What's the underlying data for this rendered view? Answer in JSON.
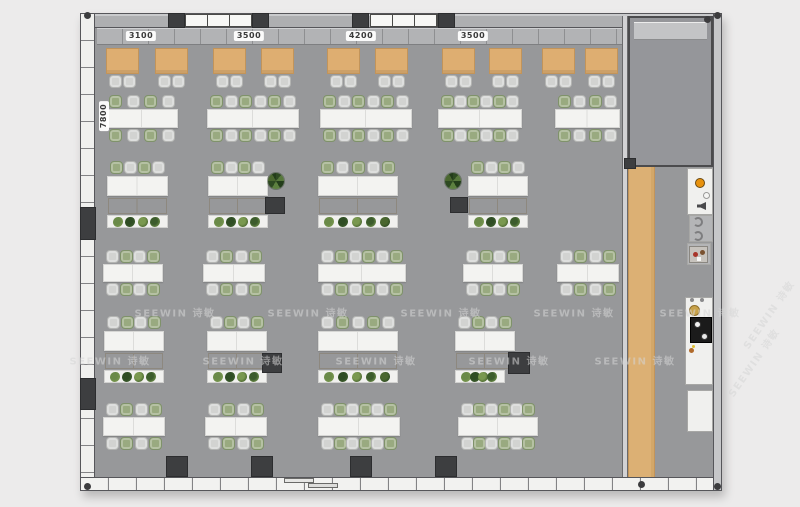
{
  "title": "Office floor plan",
  "dimension_labels": {
    "top_y": 36,
    "top": [
      {
        "text": "3100",
        "cx": 141
      },
      {
        "text": "3500",
        "cx": 249
      },
      {
        "text": "4200",
        "cx": 361
      },
      {
        "text": "3500",
        "cx": 473
      }
    ],
    "left": {
      "text": "7800",
      "cx": 104,
      "cy": 116
    }
  },
  "watermark": {
    "text": "SEEWIN 诗敏",
    "color": "#d6d6d6",
    "flat": [
      {
        "x": 175,
        "y": 312
      },
      {
        "x": 308,
        "y": 312
      },
      {
        "x": 441,
        "y": 312
      },
      {
        "x": 574,
        "y": 312
      },
      {
        "x": 700,
        "y": 312
      },
      {
        "x": 110,
        "y": 360
      },
      {
        "x": 243,
        "y": 360
      },
      {
        "x": 376,
        "y": 360
      },
      {
        "x": 509,
        "y": 360
      },
      {
        "x": 635,
        "y": 360
      }
    ],
    "rotated": [
      {
        "x": 768,
        "y": 314,
        "rot": -55
      },
      {
        "x": 753,
        "y": 362,
        "rot": -55
      }
    ]
  },
  "palette": {
    "floor": "#97989a",
    "wood_table": "#deae71",
    "wood_border": "#c2945a",
    "chair_gray": "#d2d3d1",
    "chair_gray_border": "#b3b4b2",
    "chair_green": "#99aa80",
    "chair_green_border": "#7f926a",
    "table_white": "#f3f3f1",
    "table_border": "#d6d6d4",
    "cabinet": "#aaa49c",
    "pillar": "#3d3e40",
    "walkway_wood": "#dcb074",
    "plant_greens": [
      "#4a672f",
      "#6a8a48",
      "#2f4d24",
      "#79984f",
      "#3c5c2c"
    ]
  },
  "furniture": {
    "booth_tables": {
      "y": 48,
      "w": 33,
      "h": 26,
      "chair_y": 75,
      "xs": [
        106,
        155,
        213,
        261,
        327,
        375,
        442,
        489,
        542,
        585
      ]
    },
    "meeting_rows": [
      {
        "name": "row-b",
        "table_y": 109,
        "table_h": 19,
        "phase": 0,
        "clusters": [
          {
            "x": 106,
            "w": 72,
            "seats": 4
          },
          {
            "x": 207,
            "w": 92,
            "seats": 6
          },
          {
            "x": 320,
            "w": 92,
            "seats": 6
          },
          {
            "x": 438,
            "w": 84,
            "seats": 6
          },
          {
            "x": 555,
            "w": 65,
            "seats": 4
          }
        ]
      },
      {
        "name": "row-d",
        "table_y": 264,
        "table_h": 18,
        "phase": 1,
        "clusters": [
          {
            "x": 103,
            "w": 60,
            "seats": 4
          },
          {
            "x": 203,
            "w": 62,
            "seats": 4
          },
          {
            "x": 318,
            "w": 88,
            "seats": 6
          },
          {
            "x": 463,
            "w": 60,
            "seats": 4
          },
          {
            "x": 557,
            "w": 62,
            "seats": 4
          }
        ]
      },
      {
        "name": "row-f",
        "table_y": 417,
        "table_h": 19,
        "phase": 1,
        "clusters": [
          {
            "x": 103,
            "w": 62,
            "seats": 4
          },
          {
            "x": 205,
            "w": 62,
            "seats": 4
          },
          {
            "x": 318,
            "w": 82,
            "seats": 6
          },
          {
            "x": 458,
            "w": 80,
            "seats": 6
          }
        ]
      }
    ],
    "workstation_rows": [
      {
        "name": "row-c",
        "desk_y": 176,
        "phase": 0,
        "clusters": [
          {
            "x": 107,
            "w": 61,
            "seats": 4,
            "plants": 4
          },
          {
            "x": 208,
            "w": 60,
            "seats": 4,
            "plants": 4
          },
          {
            "x": 318,
            "w": 80,
            "seats": 5,
            "plants": 5
          },
          {
            "x": 468,
            "w": 60,
            "seats": 4,
            "plants": 4
          }
        ]
      },
      {
        "name": "row-e",
        "desk_y": 331,
        "phase": 1,
        "clusters": [
          {
            "x": 104,
            "w": 60,
            "seats": 4,
            "plants": 4
          },
          {
            "x": 207,
            "w": 60,
            "seats": 4,
            "plants": 4
          },
          {
            "x": 318,
            "w": 80,
            "seats": 5,
            "plants": 5
          },
          {
            "x": 455,
            "w": 60,
            "seats": 4,
            "plants": 4,
            "planter_w": 50
          }
        ]
      }
    ],
    "pillars": {
      "top_wall": [
        {
          "x": 168
        },
        {
          "x": 252
        },
        {
          "x": 352
        },
        {
          "x": 438
        }
      ],
      "top_wall_y": 13,
      "top_wall_w": 17,
      "top_wall_h": 15,
      "bottom_wall": [
        {
          "x": 166
        },
        {
          "x": 251
        },
        {
          "x": 350
        },
        {
          "x": 435
        }
      ],
      "bottom_wall_y": 456,
      "bottom_wall_w": 22,
      "bottom_wall_h": 21,
      "interior": [
        {
          "x": 265,
          "y": 197,
          "w": 20,
          "h": 17
        },
        {
          "x": 450,
          "y": 197,
          "w": 18,
          "h": 16
        },
        {
          "x": 262,
          "y": 353,
          "w": 20,
          "h": 20
        },
        {
          "x": 508,
          "y": 352,
          "w": 22,
          "h": 22
        },
        {
          "x": 624,
          "y": 158,
          "w": 12,
          "h": 11
        }
      ],
      "left_wall": [
        {
          "y": 207,
          "h": 33
        },
        {
          "y": 378,
          "h": 32
        }
      ]
    },
    "potted_plants": [
      {
        "x": 276,
        "y": 181
      },
      {
        "x": 453,
        "y": 181
      }
    ]
  },
  "kitchen": {
    "counters": [
      {
        "x": 687,
        "y": 168,
        "w": 26,
        "h": 47
      },
      {
        "x": 689,
        "y": 215,
        "w": 24,
        "h": 27,
        "shade": true
      },
      {
        "x": 687,
        "y": 243,
        "w": 24,
        "h": 22,
        "shade": true
      },
      {
        "x": 685,
        "y": 297,
        "w": 28,
        "h": 88
      },
      {
        "x": 687,
        "y": 390,
        "w": 26,
        "h": 42
      }
    ],
    "items": [
      {
        "type": "circle",
        "x": 700,
        "y": 183,
        "r": 5,
        "color": "#e8920e",
        "ring": "#6b4a12"
      },
      {
        "type": "circle",
        "x": 706,
        "y": 195,
        "r": 3.5,
        "color": "#f5f5f3",
        "ring": "#9a9a98"
      },
      {
        "type": "speaker",
        "x": 697,
        "y": 202,
        "w": 9,
        "h": 8
      },
      {
        "type": "arc",
        "x": 698,
        "y": 222,
        "r": 5
      },
      {
        "type": "arc",
        "x": 698,
        "y": 236,
        "r": 5
      },
      {
        "type": "machine",
        "x": 689,
        "y": 246,
        "w": 19,
        "h": 17
      },
      {
        "type": "circle",
        "x": 694,
        "y": 310,
        "r": 5.5,
        "color": "#c8a24a",
        "ring": "#8f6f2b"
      },
      {
        "type": "dot",
        "x": 692,
        "y": 300,
        "r": 2,
        "color": "#8a8a8c"
      },
      {
        "type": "dot",
        "x": 702,
        "y": 300,
        "r": 2,
        "color": "#8a8a8c"
      },
      {
        "type": "rect",
        "x": 690,
        "y": 317,
        "w": 22,
        "h": 26,
        "color": "#1b1b1b",
        "border": "#000000"
      },
      {
        "type": "circle",
        "x": 697,
        "y": 324,
        "r": 3.5,
        "color": "#f2f2f2",
        "ring": "#3a3a3a"
      },
      {
        "type": "circle",
        "x": 704,
        "y": 336,
        "r": 3.5,
        "color": "#e8e8e8",
        "ring": "#3a3a3a"
      },
      {
        "type": "dot",
        "x": 691,
        "y": 350,
        "r": 2.5,
        "color": "#b06a2a"
      },
      {
        "type": "dot",
        "x": 698,
        "y": 352,
        "r": 2,
        "color": "#f0f0ee"
      },
      {
        "type": "dot",
        "x": 693,
        "y": 346,
        "r": 1.5,
        "color": "#e0c030"
      }
    ]
  },
  "nodes": [
    {
      "x": 87,
      "y": 15
    },
    {
      "x": 717,
      "y": 15
    },
    {
      "x": 87,
      "y": 486
    },
    {
      "x": 717,
      "y": 486
    },
    {
      "x": 707,
      "y": 19
    },
    {
      "x": 641,
      "y": 484
    }
  ]
}
